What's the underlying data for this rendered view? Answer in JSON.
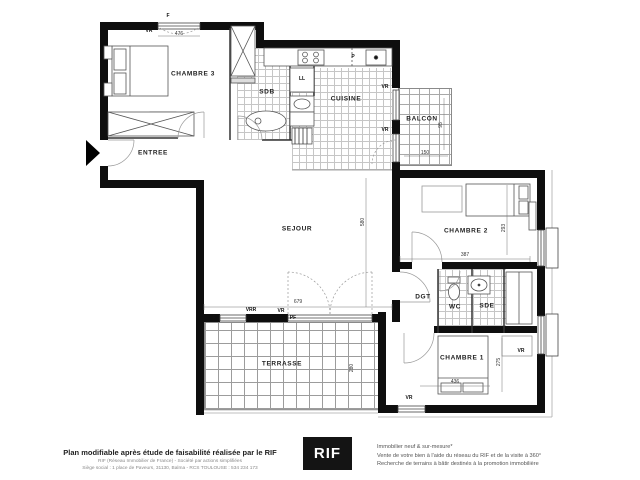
{
  "plan": {
    "rooms": {
      "chambre3": "CHAMBRE 3",
      "sdb": "SDB",
      "cuisine": "CUISINE",
      "balcon": "BALCON",
      "entree": "ENTREE",
      "sejour": "SEJOUR",
      "chambre2": "CHAMBRE 2",
      "dgt": "DGT",
      "wc": "WC",
      "sde": "SDE",
      "chambre1": "CHAMBRE 1",
      "terrasse": "TERRASSE"
    },
    "labels": {
      "f": "F",
      "pf": "PF",
      "vr": "VR",
      "vrr": "VRR",
      "ll": "LL",
      "p": "P"
    },
    "dimensions": {
      "chambre3_width": "476",
      "sejour_width": "679",
      "sejour_height": "580",
      "chambre2_width": "387",
      "chambre2_height": "293",
      "chambre1_width": "436",
      "chambre1_height": "275",
      "balcon_width": "150",
      "balcon_height": "95",
      "terrasse_height": "280"
    }
  },
  "footer": {
    "main_text": "Plan modifiable après étude de faisabilité réalisée par le RIF",
    "sub_line1": "RIF (Réseau Immobilier de France) - Société par actions simplifiées",
    "sub_line2": "Siège social : 1 place de Paveurs, 31130, Balma - RCS TOULOUSE : 534 234 173",
    "logo_text": "RIF",
    "right_line1": "Immobilier neuf & sur-mesure*",
    "right_line2": "Vente de votre bien à l'aide du réseau du RIF et de la visite à 360°",
    "right_line3": "Recherche de terrains à bâtir destinés à la promotion immobilière"
  },
  "colors": {
    "wall": "#0e0e0e",
    "tile_line": "#c6c6c6",
    "logo_bg": "#141414"
  }
}
